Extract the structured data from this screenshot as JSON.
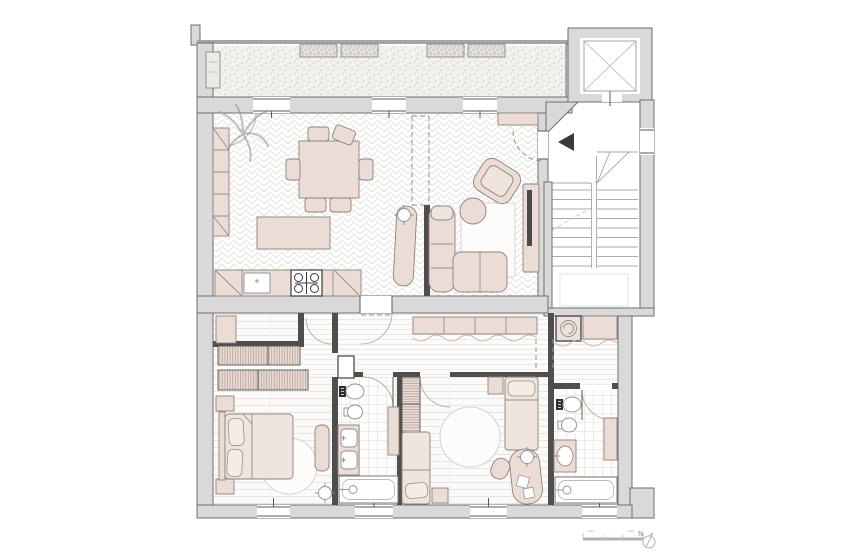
{
  "drawing": {
    "kind": "apartment-floor-plan"
  },
  "compass": {
    "label": "N"
  },
  "palette": {
    "wall_fill": "#d9d9d9",
    "wall_edge": "#6e6e6e",
    "partition": "#4e4e4e",
    "furniture_fill": "#ecdcd6",
    "furniture_stroke": "#8c8279",
    "floor_pattern_line": "#e6e2dc",
    "fixture_stroke": "#8f8f8f",
    "entrance_marker": "#3a3a3a",
    "paper": "#ffffff"
  },
  "rooms": [
    {
      "name": "balcony",
      "items": [
        "planter-box",
        "planter-box",
        "planter-box",
        "planter-box",
        "side-planter"
      ]
    },
    {
      "name": "dining-kitchen",
      "items": [
        "plant",
        "bookshelf",
        "dining-table",
        "dining-chairs",
        "kitchen-island",
        "kitchen-counter",
        "sink",
        "cooktop"
      ]
    },
    {
      "name": "living-room",
      "items": [
        "console-shelf",
        "armchair",
        "corner-sofa",
        "coffee-table",
        "side-table",
        "tv-panel",
        "radiator",
        "ceiling-light"
      ]
    },
    {
      "name": "stairwell",
      "items": [
        "elevator",
        "staircase",
        "entrance-marker"
      ]
    },
    {
      "name": "corridor",
      "items": [
        "wardrobe-row",
        "curtain",
        "service-shaft"
      ]
    },
    {
      "name": "laundry",
      "items": [
        "washing-machine",
        "counter",
        "curtain"
      ]
    },
    {
      "name": "master-bedroom",
      "items": [
        "closet-cabinet",
        "wardrobe-row",
        "wardrobe-row",
        "double-bed",
        "nightstand",
        "nightstand",
        "round-rug",
        "bench",
        "ceiling-light"
      ]
    },
    {
      "name": "bathroom-1",
      "items": [
        "toilet",
        "bidet",
        "double-sink-vanity",
        "tall-cabinet",
        "bathtub"
      ]
    },
    {
      "name": "kids-bedroom",
      "items": [
        "wardrobe",
        "single-bed",
        "single-bed",
        "nightstand",
        "round-rug",
        "desk",
        "desk-chair",
        "ceiling-light"
      ]
    },
    {
      "name": "bathroom-2",
      "items": [
        "toilet",
        "bidet",
        "sink-counter",
        "wall-cabinet",
        "bathtub"
      ]
    }
  ],
  "annotations": {
    "scale_bar": true,
    "north_arrow": true
  }
}
